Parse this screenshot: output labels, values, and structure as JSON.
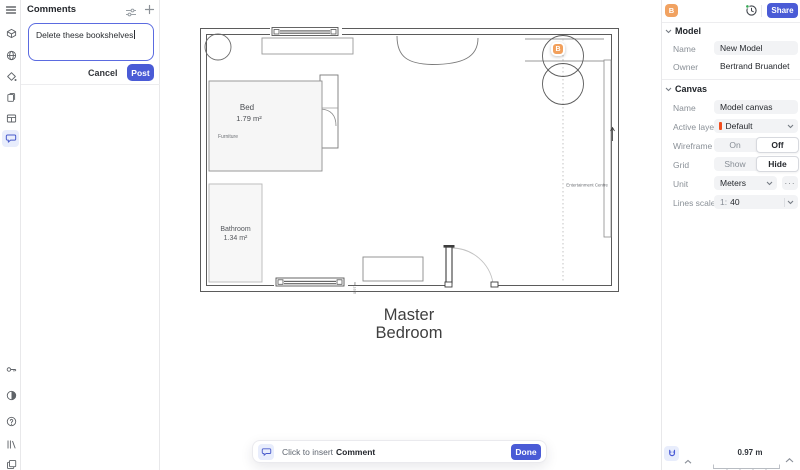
{
  "colors": {
    "accent": "#4a5bd6",
    "avatar": "#f1a261",
    "collab_badge": "#f2a05c",
    "layer_swatch": "#f24e1e",
    "active_tool_bg": "#e8edfc"
  },
  "left_rail": {
    "icons": [
      "menu-icon",
      "box-icon",
      "world-icon",
      "paint-icon",
      "pages-icon",
      "table-icon",
      "comments-icon",
      "pin-icon",
      "contrast-icon",
      "help-icon",
      "library-icon",
      "layers-icon"
    ]
  },
  "comments_panel": {
    "title": "Comments",
    "input_value": "Delete these bookshelves",
    "cancel_label": "Cancel",
    "post_label": "Post"
  },
  "floor_plan": {
    "bed_label": "Bed",
    "bed_area": "1.79 m²",
    "furniture_label": "Furniture",
    "bathroom_label": "Bathroom",
    "bathroom_area": "1.34 m²",
    "entertainment_label": "Entertainment Centre",
    "dimension_label": "0.97 m",
    "collaborator_badge": "B",
    "room_label_line1": "Master",
    "room_label_line2": "Bedroom"
  },
  "comment_toolbar": {
    "hint_regular": "Click to insert",
    "hint_bold": "Comment",
    "done_label": "Done"
  },
  "topbar": {
    "avatar_initial": "B",
    "share_label": "Share"
  },
  "model_section": {
    "title": "Model",
    "name_label": "Name",
    "name_value": "New Model",
    "owner_label": "Owner",
    "owner_value": "Bertrand Bruandet"
  },
  "canvas_section": {
    "title": "Canvas",
    "name_label": "Name",
    "name_value": "Model canvas",
    "active_layer_label": "Active layer",
    "active_layer_value": "Default",
    "wireframe_label": "Wireframe",
    "wireframe_on": "On",
    "wireframe_off": "Off",
    "wireframe_selected": "Off",
    "grid_label": "Grid",
    "grid_show": "Show",
    "grid_hide": "Hide",
    "grid_selected": "Hide",
    "unit_label": "Unit",
    "unit_value": "Meters",
    "more_label": "···",
    "lines_scale_label": "Lines scale",
    "lines_scale_prefix": "1:",
    "lines_scale_value": "40"
  },
  "status_bar": {
    "scale_value": "0.97 m"
  }
}
